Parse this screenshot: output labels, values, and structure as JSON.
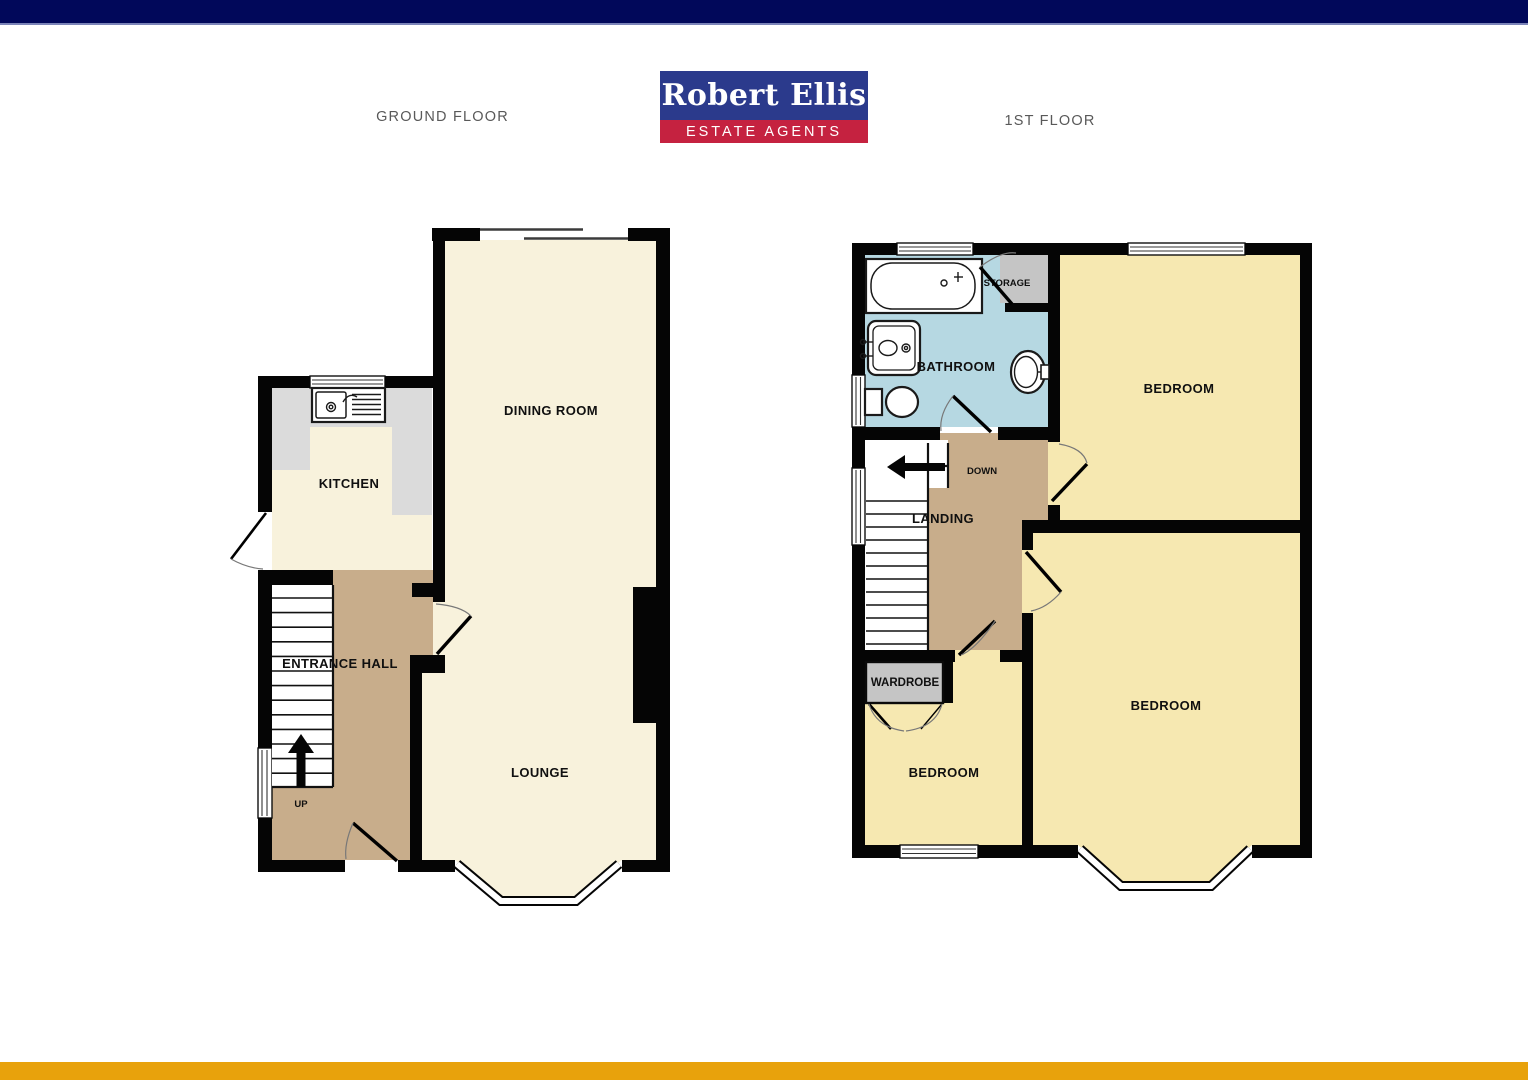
{
  "header": {
    "ground_floor_label": "GROUND FLOOR",
    "first_floor_label": "1ST FLOOR"
  },
  "logo": {
    "brand": "Robert Ellis",
    "tagline": "ESTATE AGENTS"
  },
  "ground_floor": {
    "rooms": {
      "dining_room": "DINING ROOM",
      "kitchen": "KITCHEN",
      "entrance_hall": "ENTRANCE HALL",
      "lounge": "LOUNGE"
    },
    "stairs_direction": "UP"
  },
  "first_floor": {
    "rooms": {
      "bathroom": "BATHROOM",
      "storage": "STORAGE",
      "bedroom_top": "BEDROOM",
      "bedroom_left": "BEDROOM",
      "bedroom_right": "BEDROOM",
      "landing": "LANDING",
      "wardrobe": "WARDROBE"
    },
    "stairs_direction": "DOWN"
  },
  "colors": {
    "top_bar": "#01085A",
    "top_bar_edge": "#7B84B8",
    "bottom_bar": "#E8A20C",
    "logo_navy": "#2B3A8C",
    "logo_red": "#C52240",
    "room_cream": "#F8F2DC",
    "room_yellow": "#F6E8B1",
    "hall_tan": "#C8AD8B",
    "bathroom_blue": "#B6D8E2",
    "counter_gray": "#DBDBDB",
    "closet_gray": "#C5C5C5",
    "wall_black": "#050505",
    "floor_label_gray": "#595959"
  }
}
